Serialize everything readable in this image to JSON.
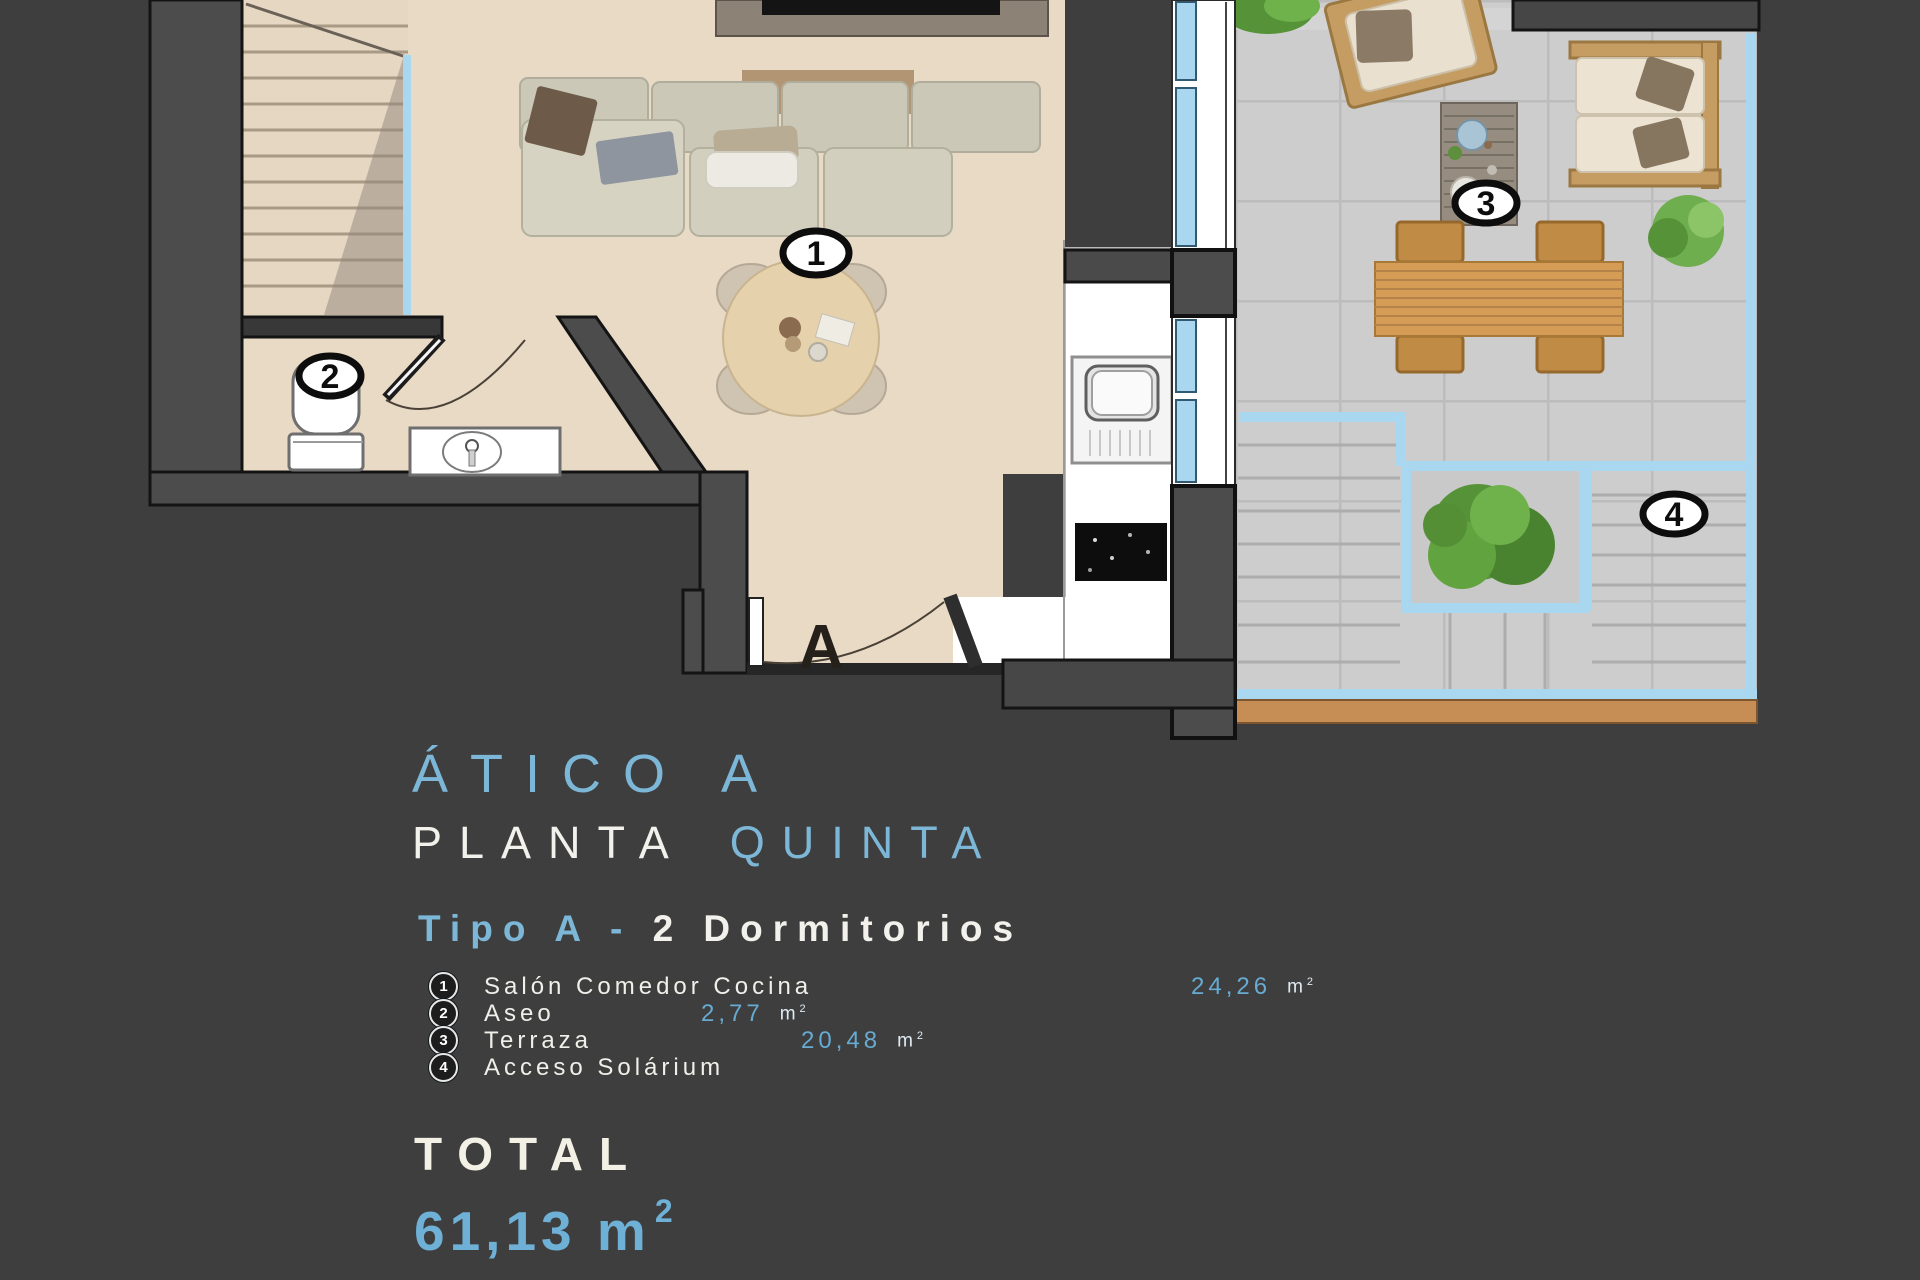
{
  "plan": {
    "badge_salon": "1",
    "badge_aseo": "2",
    "badge_terraza": "3",
    "badge_solarium": "4",
    "entrance_label": "A"
  },
  "info": {
    "title": "ÁTICO A",
    "subtitle_white": "PLANTA",
    "subtitle_accent": "QUINTA",
    "type_accent": "Tipo A -",
    "type_rest": "2 Dormitorios",
    "legend": [
      {
        "num": "1",
        "label": "Salón Comedor Cocina",
        "value": "24,26",
        "unit": "m",
        "sup": "2"
      },
      {
        "num": "2",
        "label": "Aseo",
        "value": "2,77",
        "unit": "m",
        "sup": "2"
      },
      {
        "num": "3",
        "label": "Terraza",
        "value": "20,48",
        "unit": "m",
        "sup": "2"
      },
      {
        "num": "4",
        "label": "Acceso Solárium",
        "value": "",
        "unit": "",
        "sup": ""
      }
    ],
    "total_label": "TOTAL",
    "total_value": "61,13",
    "total_unit": "m",
    "total_sup": "2"
  },
  "colors": {
    "background": "#3e3e3e",
    "accent_blue": "#7db7d7",
    "value_blue": "#67aad2",
    "glazing_blue": "#a9d7f0",
    "floor_beige": "#e9dac6",
    "terrace_tile": "#cdcdcd",
    "wood": "#d49c55"
  }
}
